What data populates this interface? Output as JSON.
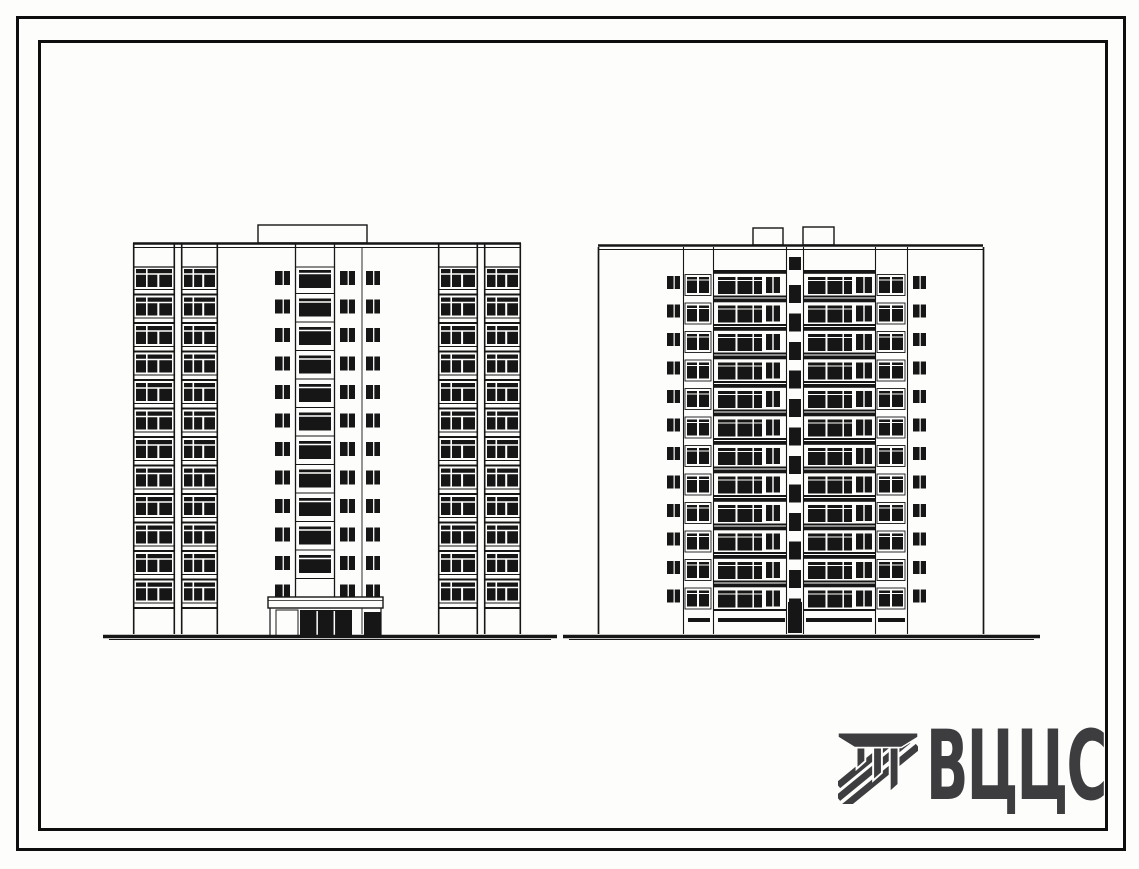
{
  "page": {
    "bg": "#fdfdfc",
    "ink": "#161616",
    "paper": "#ffffff"
  },
  "logo": {
    "text": "ВЦЦС",
    "color": "#3d3d3f",
    "icon": "hatched-beam-logo-icon"
  },
  "drawing_title": "Two facade elevations of a 12-storey panel apartment building",
  "elevations": {
    "left": {
      "name": "main-facade-elevation",
      "floors": 12,
      "x0": 133,
      "x1": 521,
      "top": 243,
      "bottom": 634,
      "first_floor_y": 268,
      "floor_h": 28.5,
      "bays": [
        [
          133,
          175
        ],
        [
          181,
          218
        ],
        [
          438,
          478
        ],
        [
          484,
          521
        ]
      ],
      "small_cols": [
        [
          275,
          15
        ],
        [
          340,
          15
        ],
        [
          366,
          14
        ]
      ],
      "strip": {
        "x0": 295,
        "x1": 335,
        "bottom": 597
      },
      "joint_x": 362,
      "roof_box": [
        258,
        225,
        109,
        18
      ],
      "canopy": [
        268,
        597,
        115,
        11
      ],
      "door_light": [
        [
          276,
          610,
          22,
          26
        ]
      ],
      "door_dark": [
        [
          300,
          610,
          52,
          26
        ],
        [
          364,
          612,
          17,
          24
        ]
      ]
    },
    "right": {
      "name": "courtyard-facade-elevation",
      "floors": 12,
      "x0": 598,
      "x1": 983,
      "top": 245,
      "bottom": 634,
      "first_floor_y": 270,
      "floor_h": 28.5,
      "verticals": [
        598,
        683,
        713,
        786,
        803,
        875,
        907,
        983
      ],
      "bands": [
        [
          713,
          786
        ],
        [
          803,
          875
        ]
      ],
      "band_windows": [
        {
          "big": [
            718,
            44
          ],
          "small": [
            766,
            14
          ]
        },
        {
          "big": [
            808,
            44
          ],
          "small": [
            856,
            16
          ]
        }
      ],
      "narrow_bays": [
        [
          683,
          713
        ],
        [
          875,
          907
        ]
      ],
      "small_cols": [
        [
          667,
          13
        ],
        [
          913,
          13
        ]
      ],
      "stair": {
        "win_x": 789,
        "win_w": 12
      },
      "roof_boxes": [
        [
          753,
          228,
          30,
          17
        ],
        [
          803,
          227,
          31,
          18
        ]
      ],
      "base_slots": [
        [
          688,
          22
        ],
        [
          718,
          67
        ],
        [
          806,
          66
        ],
        [
          878,
          27
        ]
      ],
      "stair_door": [
        788,
        602,
        14,
        31
      ]
    }
  },
  "ground": {
    "y": 636,
    "segments": [
      [
        103,
        557
      ],
      [
        563,
        1040
      ]
    ]
  }
}
